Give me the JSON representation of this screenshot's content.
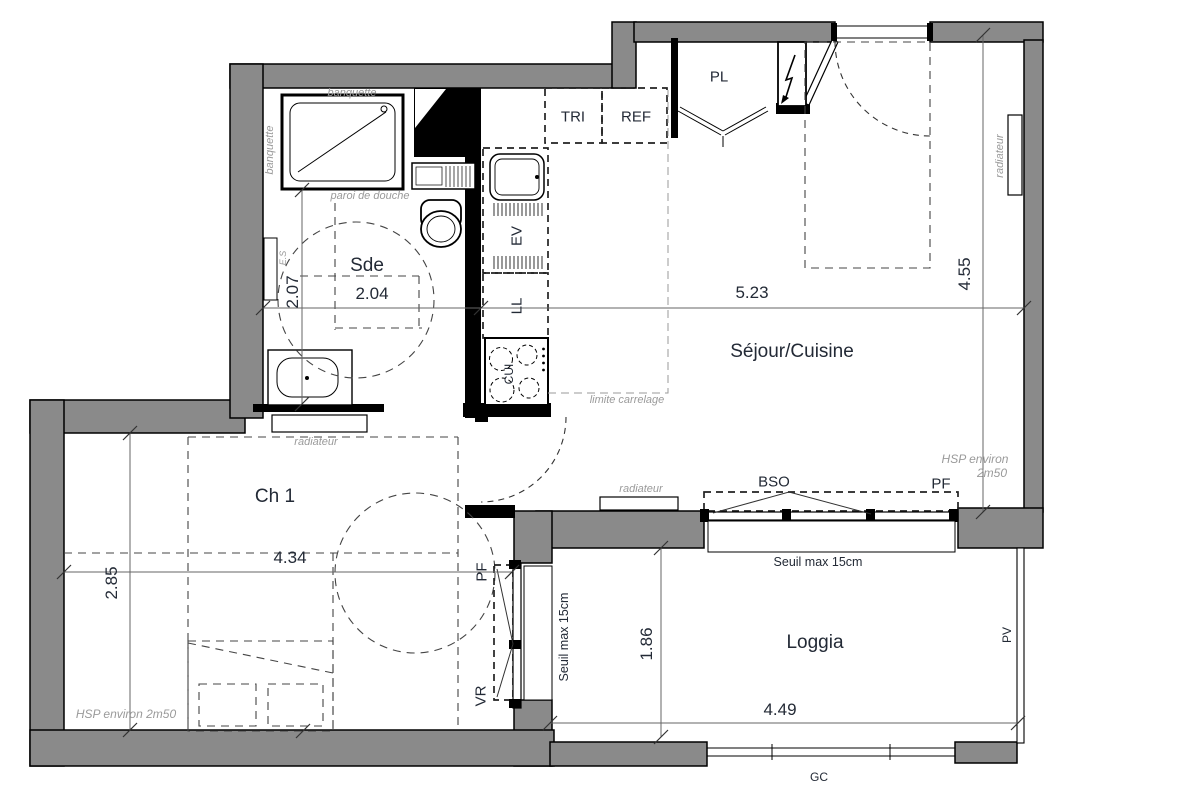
{
  "rooms": {
    "sde": {
      "name": "Sde",
      "width_m": "2.04",
      "depth_m": "2.07"
    },
    "sejour_cuisine": {
      "name": "Séjour/Cuisine",
      "width_m": "5.23",
      "depth_m": "4.55"
    },
    "ch1": {
      "name": "Ch 1",
      "width_m": "4.34",
      "depth_m": "2.85"
    },
    "loggia": {
      "name": "Loggia",
      "width_m": "4.49",
      "depth_m": "1.86"
    }
  },
  "equipment_labels": {
    "pl": "PL",
    "tri": "TRI",
    "ref": "REF",
    "ev": "EV",
    "ll": "LL",
    "cui": "CUI",
    "bso": "BSO",
    "pf": "PF",
    "vr": "VR",
    "pv": "PV",
    "gc": "GC"
  },
  "annotations": {
    "banquette": "banquette",
    "paroi_de_douche": "paroi de douche",
    "radiateur": "radiateur",
    "limite_carrelage": "limite carrelage",
    "hsp": "HSP environ 2m50",
    "hsp_line1": "HSP environ",
    "hsp_line2": "2m50",
    "seuil": "Seuil max 15cm",
    "es": "E.S"
  },
  "colors": {
    "wall": "#8a8a8a",
    "text_dark": "#232a36",
    "text_gray": "#9a9a9a"
  }
}
